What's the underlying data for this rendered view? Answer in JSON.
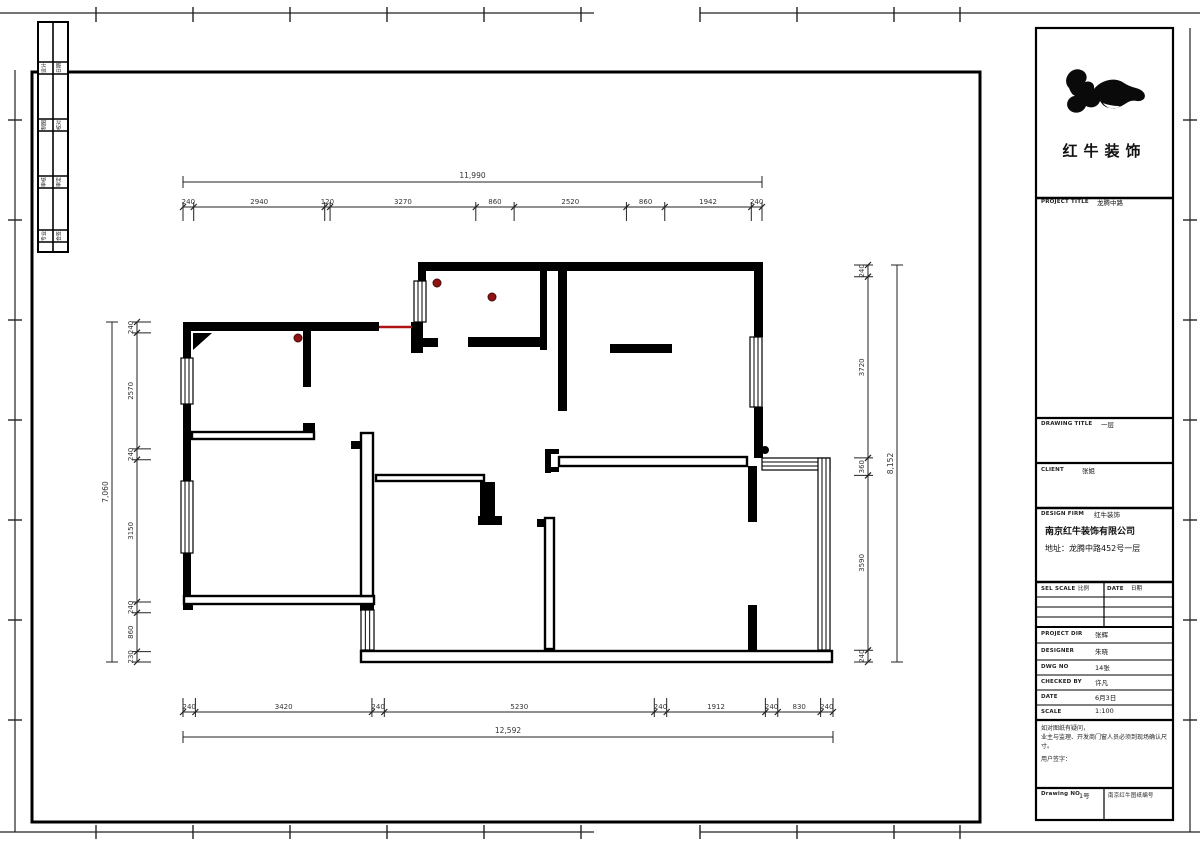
{
  "sheet": {
    "logo_text": "红牛装饰",
    "accent_color": "#b01212",
    "wall_color": "#000000"
  },
  "title_block": {
    "project_title_label": "PROJECT TITLE",
    "project_title": "龙腾中路",
    "drawing_title_label": "DRAWING TITLE",
    "drawing_title": "一层",
    "client_label": "CLIENT",
    "client": "张姐",
    "firm_label": "DESIGN FIRM",
    "firm": "红牛装饰",
    "company": "南京红牛装饰有限公司",
    "address": "地址：龙腾中路452号一层",
    "col_scale_label": "SEL SCALE",
    "col_scale": "比例",
    "col_date_label": "DATE",
    "col_date": "日期",
    "rows": [
      {
        "label": "PROJECT DIR",
        "value": "张辉"
      },
      {
        "label": "DESIGNER",
        "value": "朱晓"
      },
      {
        "label": "DWG NO",
        "value": "14张"
      },
      {
        "label": "CHECKED BY",
        "value": "许凡"
      },
      {
        "label": "DATE",
        "value": "6月3日"
      },
      {
        "label": "SCALE",
        "value": "1:100"
      }
    ],
    "note1": "如对图纸有疑问，",
    "note2": "业主与监理、开发商门窗人员必须到现场确认尺寸。",
    "note3": "用户签字：",
    "drawing_no_label": "Drawing NO",
    "drawing_no": "1号",
    "archive_no": "南京红牛图纸编号"
  },
  "strip": {
    "labels": [
      [
        "设计",
        "日期"
      ],
      [
        "制图",
        "校对"
      ],
      [
        "审核",
        "审定"
      ],
      [
        "专业",
        "会签"
      ]
    ]
  },
  "plan": {
    "walls_solid": [
      [
        418,
        262,
        345,
        9
      ],
      [
        754,
        271,
        9,
        66
      ],
      [
        754,
        407,
        9,
        51
      ],
      [
        183,
        322,
        196,
        9
      ],
      [
        183,
        331,
        8,
        27
      ],
      [
        183,
        404,
        8,
        77
      ],
      [
        183,
        553,
        8,
        57
      ],
      [
        418,
        262,
        8,
        20
      ],
      [
        540,
        262,
        7,
        88
      ],
      [
        468,
        337,
        79,
        10
      ],
      [
        558,
        271,
        9,
        140
      ],
      [
        610,
        344,
        62,
        9
      ],
      [
        748,
        466,
        9,
        56
      ],
      [
        748,
        605,
        9,
        46
      ],
      [
        303,
        331,
        8,
        56
      ],
      [
        411,
        322,
        12,
        31
      ],
      [
        423,
        338,
        15,
        9
      ],
      [
        545,
        449,
        6,
        24
      ],
      [
        545,
        449,
        14,
        5
      ],
      [
        545,
        467,
        14,
        5
      ],
      [
        537,
        519,
        7,
        8
      ],
      [
        351,
        441,
        10,
        8
      ],
      [
        480,
        482,
        15,
        37
      ],
      [
        478,
        516,
        24,
        9
      ],
      [
        303,
        423,
        12,
        9
      ],
      [
        360,
        597,
        14,
        14
      ],
      [
        183,
        603,
        10,
        7
      ]
    ],
    "walls_outlined": [
      [
        183,
        595,
        192,
        10
      ],
      [
        360,
        650,
        473,
        13
      ],
      [
        558,
        456,
        190,
        11
      ],
      [
        544,
        517,
        11,
        133
      ],
      [
        360,
        432,
        14,
        165
      ],
      [
        375,
        474,
        110,
        8
      ],
      [
        191,
        431,
        124,
        9
      ]
    ],
    "door_marks": [
      "193,333 212,333 193,350"
    ],
    "windows": [
      {
        "x": 181,
        "y": 358,
        "w": 12,
        "h": 46,
        "o": "v"
      },
      {
        "x": 181,
        "y": 481,
        "w": 12,
        "h": 72,
        "o": "v"
      },
      {
        "x": 414,
        "y": 281,
        "w": 12,
        "h": 41,
        "o": "v"
      },
      {
        "x": 750,
        "y": 337,
        "w": 12,
        "h": 70,
        "o": "v"
      },
      {
        "x": 762,
        "y": 458,
        "w": 68,
        "h": 12,
        "o": "h"
      },
      {
        "x": 818,
        "y": 458,
        "w": 12,
        "h": 192,
        "o": "v"
      },
      {
        "x": 361,
        "y": 610,
        "w": 13,
        "h": 40,
        "o": "v"
      }
    ],
    "red_line": [
      379,
      327,
      412,
      327
    ],
    "red_dots": [
      [
        437,
        283
      ],
      [
        492,
        297
      ],
      [
        298,
        338
      ]
    ],
    "black_dots": [
      [
        765,
        450
      ]
    ]
  },
  "dimensions": {
    "top": {
      "orient": "h",
      "seg_pos": 207,
      "all_pos": 182,
      "from": 183,
      "to": 762,
      "segments": [
        240,
        2940,
        120,
        3270,
        860,
        2520,
        860,
        1942,
        240
      ],
      "overall": "11,990",
      "tick_dir": 1
    },
    "bottom": {
      "orient": "h",
      "seg_pos": 712,
      "all_pos": 737,
      "from": 183,
      "to": 833,
      "segments": [
        240,
        3420,
        240,
        5230,
        240,
        1912,
        240,
        830,
        240
      ],
      "overall": "12,592",
      "tick_dir": -1
    },
    "left": {
      "orient": "v",
      "seg_pos": 137,
      "all_pos": 112,
      "from": 322,
      "to": 662,
      "segments": [
        240,
        2570,
        240,
        3150,
        240,
        860,
        230
      ],
      "overall": "7,060",
      "tick_dir": 1
    },
    "right": {
      "orient": "v",
      "seg_pos": 868,
      "all_pos": 897,
      "from": 265,
      "to": 662,
      "segments": [
        240,
        3720,
        360,
        3590,
        240
      ],
      "overall": "8,152",
      "tick_dir": -1
    }
  },
  "frame": {
    "main_rect": [
      32,
      72,
      948,
      750
    ],
    "title_rect": [
      1036,
      28,
      137,
      792
    ],
    "edge_lines": [
      [
        0,
        13,
        594,
        13
      ],
      [
        700,
        13,
        1200,
        13
      ],
      [
        0,
        832,
        594,
        832
      ],
      [
        700,
        832,
        1200,
        832
      ],
      [
        15,
        70,
        15,
        832
      ],
      [
        1190,
        28,
        1190,
        832
      ]
    ],
    "ticks_top_x": [
      96,
      193,
      290,
      387,
      484,
      581,
      700,
      797,
      894,
      960
    ],
    "ticks_bottom_x": [
      96,
      193,
      290,
      387,
      484,
      581,
      700,
      797,
      894,
      960
    ],
    "ticks_left_y": [
      120,
      220,
      320,
      420,
      520,
      620,
      720
    ],
    "ticks_right_y": [
      120,
      220,
      320,
      420,
      520,
      620,
      720
    ],
    "tb_hlines": [
      [
        198,
        2.5
      ],
      [
        418,
        2.2
      ],
      [
        463,
        2.2
      ],
      [
        508,
        2.5
      ],
      [
        582,
        2.5
      ],
      [
        597,
        1
      ],
      [
        607,
        1
      ],
      [
        617,
        1
      ],
      [
        627,
        2
      ],
      [
        643,
        1
      ],
      [
        660,
        1
      ],
      [
        675,
        1
      ],
      [
        690,
        1
      ],
      [
        705,
        1
      ],
      [
        720,
        2.2
      ],
      [
        788,
        2.2
      ]
    ],
    "tb_vlines": [
      [
        1104,
        582,
        627
      ],
      [
        1104,
        788,
        820
      ]
    ],
    "strip_rect": [
      38,
      22,
      30,
      230
    ],
    "strip_hlines": [
      62,
      74,
      119,
      131,
      176,
      188,
      230,
      242
    ],
    "strip_vline_x": 53,
    "strip_label_y": [
      68,
      125,
      182,
      236
    ],
    "strip_cols_x": [
      45.5,
      60.5
    ]
  }
}
